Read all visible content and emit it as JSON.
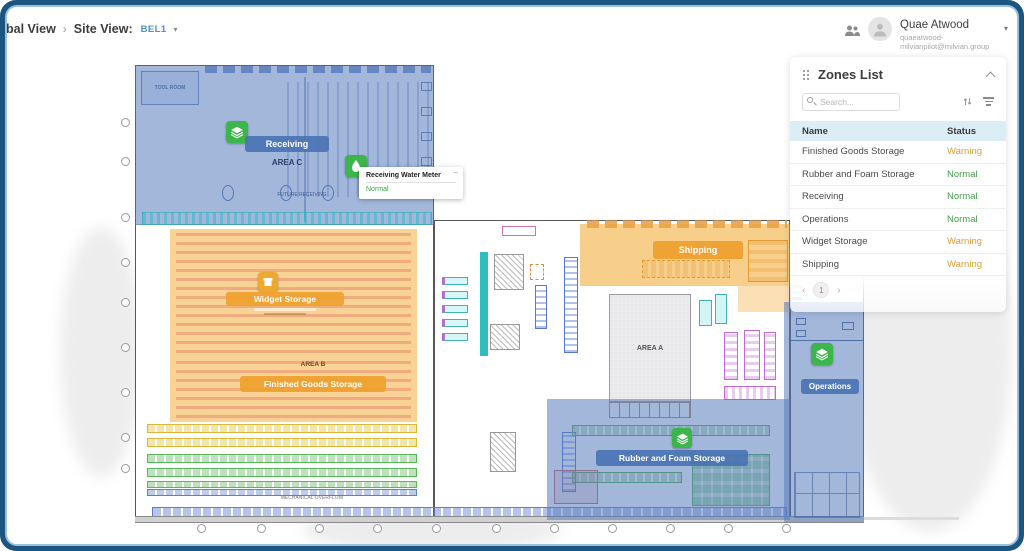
{
  "header": {
    "breadcrumb": {
      "root": "bal View",
      "separator": "›",
      "site_label": "Site View:",
      "site_value": "BEL1"
    },
    "user": {
      "name": "Quae Atwood",
      "email": "quaeatwood-milvianpilot@milvian.group"
    }
  },
  "zones_panel": {
    "title": "Zones List",
    "search_placeholder": "Search...",
    "columns": {
      "name": "Name",
      "status": "Status"
    },
    "rows": [
      {
        "name": "Finished Goods Storage",
        "status": "Warning"
      },
      {
        "name": "Rubber and Foam Storage",
        "status": "Normal"
      },
      {
        "name": "Receiving",
        "status": "Normal"
      },
      {
        "name": "Operations",
        "status": "Normal"
      },
      {
        "name": "Widget Storage",
        "status": "Warning"
      },
      {
        "name": "Shipping",
        "status": "Warning"
      }
    ],
    "pagination": {
      "prev": "‹",
      "page": "1",
      "next": "›"
    }
  },
  "map": {
    "labels": {
      "receiving": "Receiving",
      "area_c": "AREA C",
      "widget_storage": "Widget Storage",
      "area_b": "AREA B",
      "finished_goods": "Finished Goods Storage",
      "shipping": "Shipping",
      "rubber_foam": "Rubber and Foam Storage",
      "operations": "Operations",
      "area_a": "AREA A",
      "tool_room": "TOOL ROOM",
      "future_receiving": "FUTURE RECEIVING",
      "mechanical_overflow": "MECHANICAL OVERFLOW"
    },
    "tooltip": {
      "title": "Receiving Water Meter",
      "status": "Normal"
    }
  },
  "colors": {
    "warning": "#DBA136",
    "normal": "#43A047",
    "zone_blue": "#587CBE",
    "zone_orange": "#F3A62B",
    "icon_green": "#3CB54B",
    "frame_border": "#1B5580",
    "accent_link": "#4A90D9"
  },
  "icons": [
    "people-icon",
    "avatar-icon",
    "caret-down-icon",
    "drag-handle-icon",
    "collapse-chevron-icon",
    "search-icon",
    "sort-icon",
    "filter-icon",
    "layers-icon",
    "water-drop-icon",
    "storage-box-icon",
    "prev-page-icon",
    "next-page-icon",
    "grid-marker"
  ]
}
